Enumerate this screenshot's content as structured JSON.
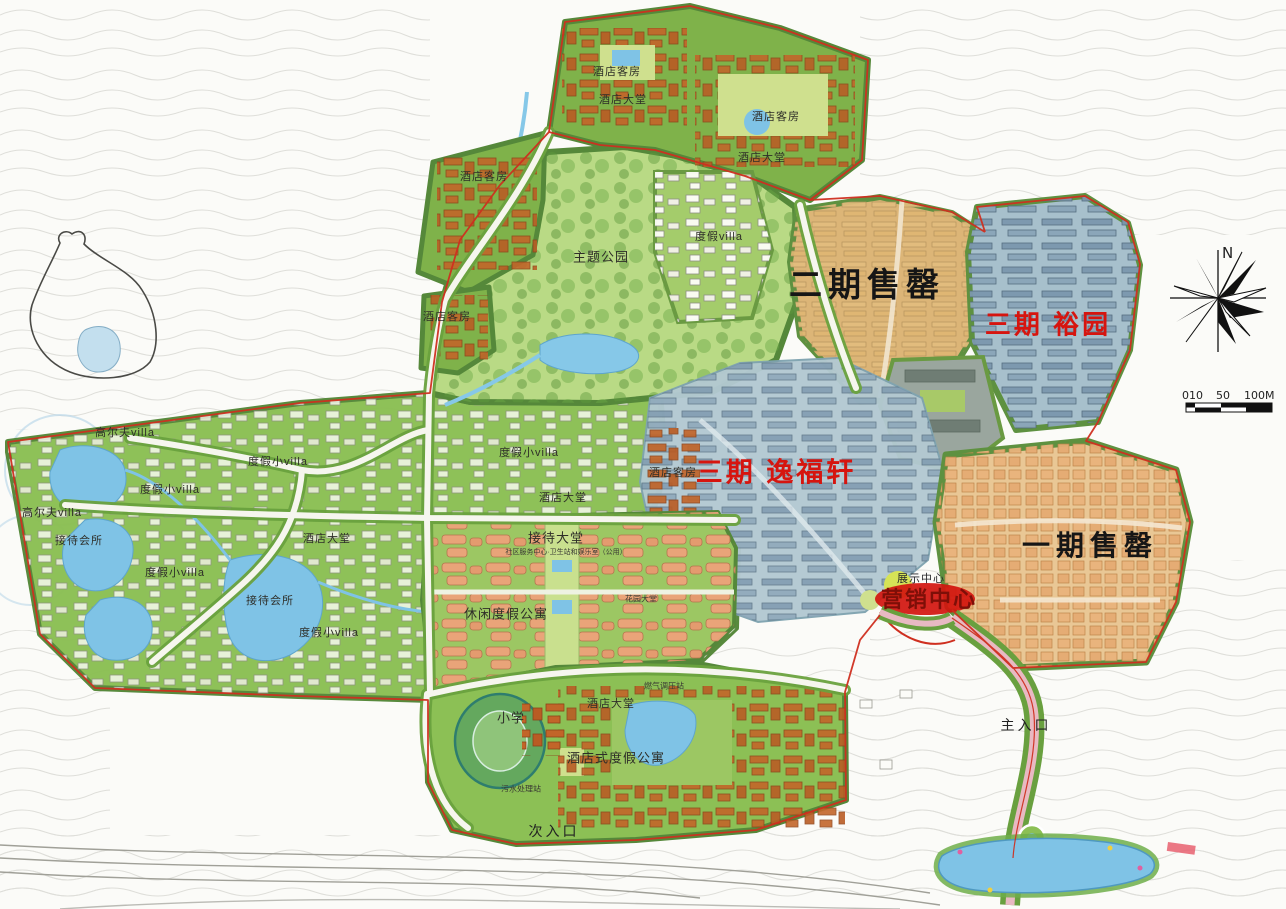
{
  "phase_labels": {
    "phase2_sold": "二期售罄",
    "phase3_yuyuan": "三期 裕园",
    "phase3_yifuxuan": "三期 逸福轩",
    "phase1_sold": "一期售罄",
    "exhibition_center": "展示中心",
    "marketing_center": "营销中心"
  },
  "site_labels": {
    "hotel_rooms": "酒店客房",
    "hotel_lobby": "酒店大堂",
    "theme_park": "主题公园",
    "resort_villa": "度假villa",
    "small_resort_villa": "度假小villa",
    "golf_villa": "高尔夫villa",
    "reception_club": "接待会所",
    "reception_hall": "接待大堂",
    "reception_note": "社区服务中心·卫生站和娱乐室（公用）",
    "garden_hall": "花园大堂",
    "leisure_apartments": "休闲度假公寓",
    "primary_school": "小学",
    "hotel_style_apartments": "酒店式度假公寓",
    "sewage_station": "污水处理站",
    "gas_station": "燃气调压站",
    "secondary_entrance": "次入口",
    "main_entrance": "主入口"
  },
  "compass": {
    "north_label": "N"
  },
  "scale_bar": {
    "tick_left": "010",
    "tick_mid": "50",
    "tick_right": "100M"
  },
  "colors": {
    "site_green": "#8cc055",
    "park_green": "#b9da85",
    "water_blue": "#7fc3e6",
    "phase1_peach": "#e9c795",
    "phase2_tan": "#dcb577",
    "phase3_blue": "#a7c0cc",
    "hotel_orange": "#c26529",
    "apartment_salmon": "#eda27a",
    "boundary_red": "#cf2f1f",
    "label_red": "#d6150f",
    "label_black": "#161616"
  }
}
